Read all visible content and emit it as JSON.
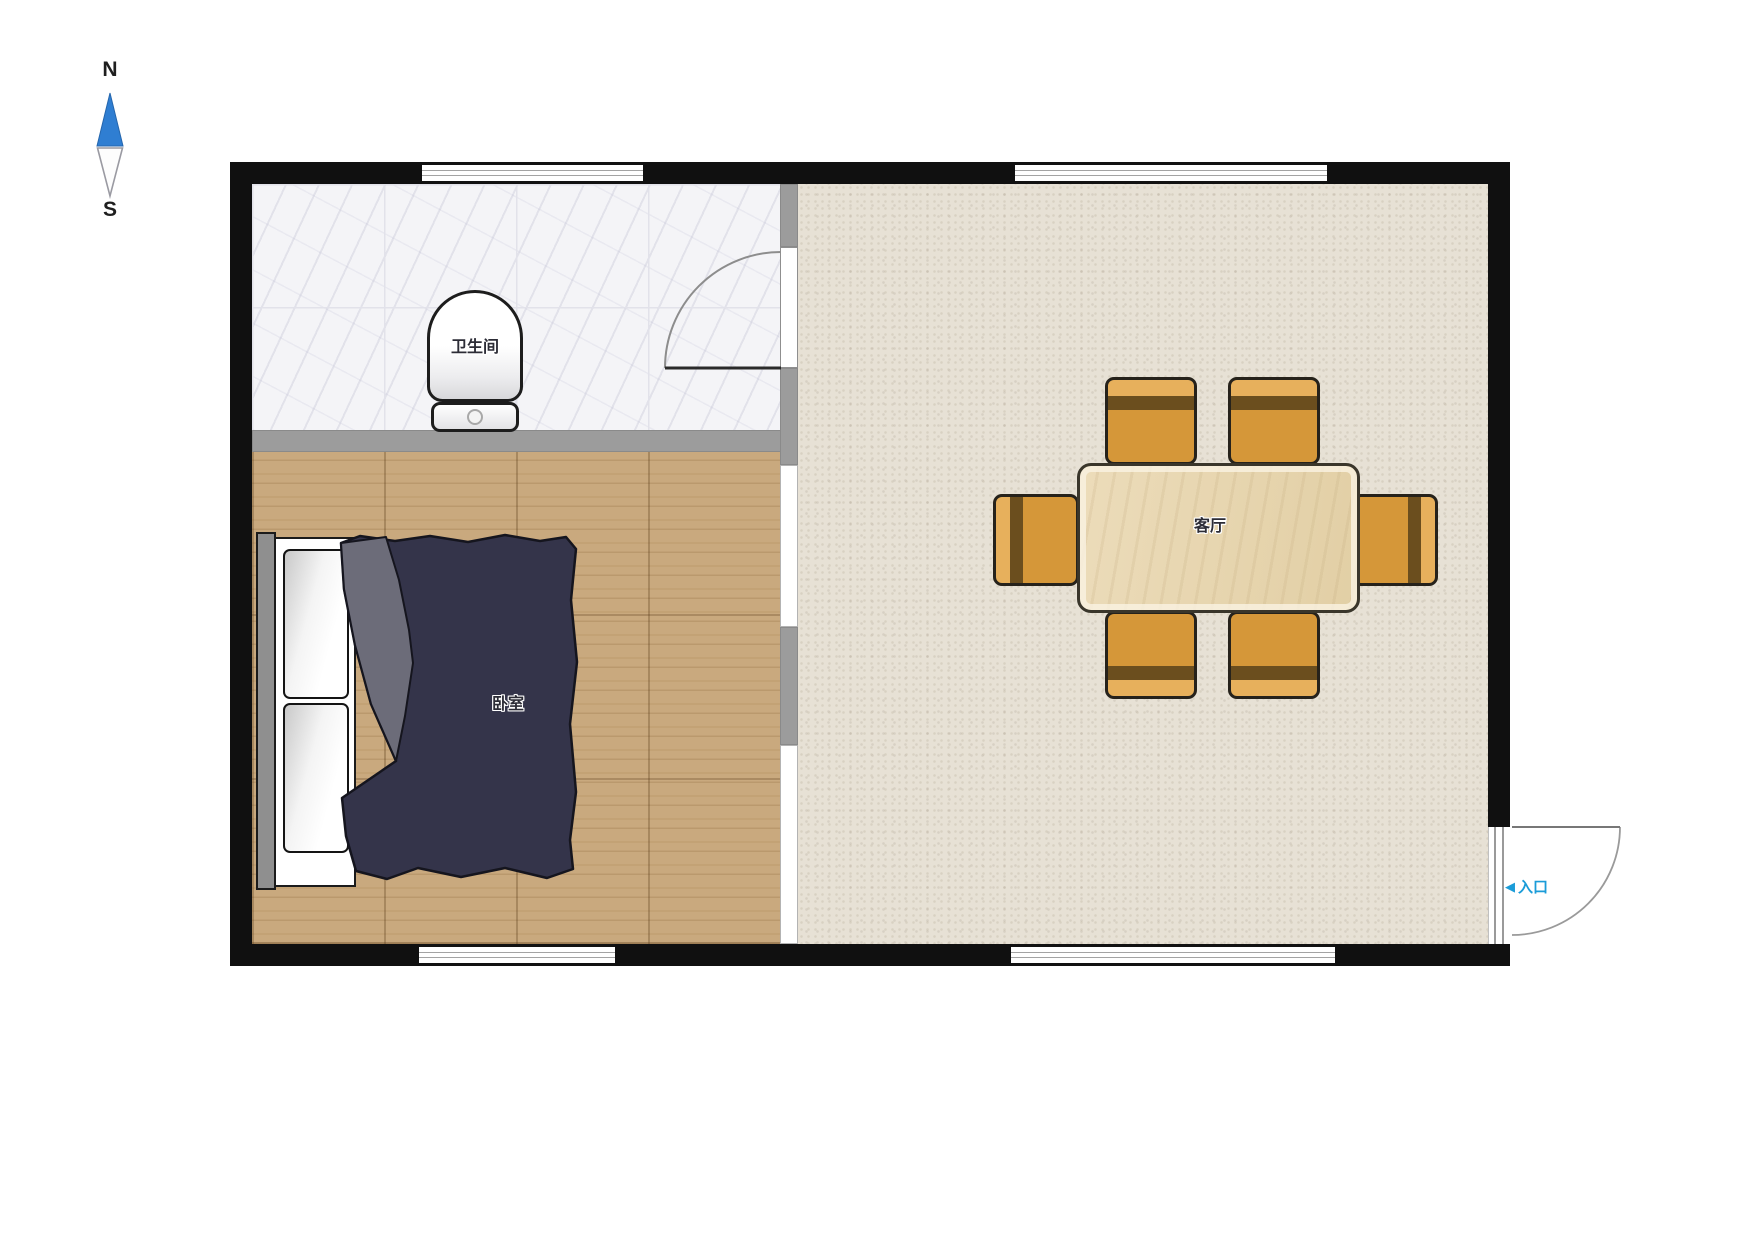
{
  "compass": {
    "north": "N",
    "south": "S"
  },
  "rooms": {
    "bathroom": {
      "label": "卫生间"
    },
    "bedroom": {
      "label": "卧室"
    },
    "living_room": {
      "label": "客厅"
    },
    "entrance": {
      "label": "入口",
      "arrow_icon": "◀"
    }
  },
  "furniture": {
    "dining_chair_count": 6,
    "items": [
      "toilet",
      "double-bed",
      "dining-table",
      "dining-chairs"
    ]
  },
  "colors": {
    "wall_black": "#101010",
    "interior_wall_gray": "#9c9c9c",
    "entrance_blue": "#1b9cd8",
    "compass_blue": "#2f7ed2",
    "blanket_navy": "#34344a",
    "blanket_fold_gray": "#6c6c79",
    "chair_orange": "#d59739",
    "chair_backrest_brown": "#6b4e1e",
    "table_wood": "#e6d4ac",
    "wood_floor": "#c9a97e",
    "living_floor_beige": "#e7e1d5",
    "bathroom_tile": "#f4f4f7"
  }
}
